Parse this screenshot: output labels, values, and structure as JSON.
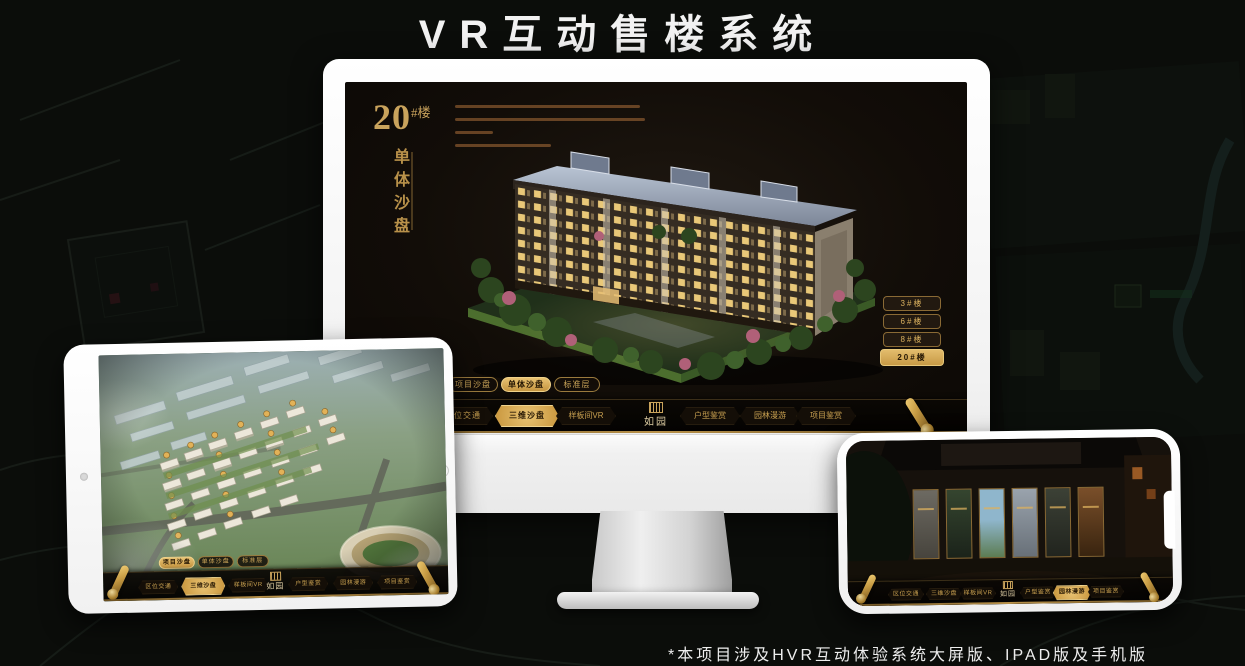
{
  "page": {
    "title": "VR互动售楼系统",
    "footnote": "*本项目涉及HVR互动体验系统大屏版、IPAD版及手机版"
  },
  "colors": {
    "gold": "#c9a35c",
    "gold_active": "#d9ae58",
    "background": "#0b0d0a",
    "screen_dark": "#120d08"
  },
  "monitor_app": {
    "building_no": "20",
    "building_no_suffix": "#楼",
    "subtitle": "单体沙盘",
    "floor_buttons": [
      {
        "label": "3#楼",
        "active": false
      },
      {
        "label": "6#楼",
        "active": false
      },
      {
        "label": "8#楼",
        "active": false
      },
      {
        "label": "20#楼",
        "active": true
      }
    ],
    "view_tabs": [
      {
        "label": "项目沙盘",
        "active": false
      },
      {
        "label": "单体沙盘",
        "active": true
      },
      {
        "label": "标准层",
        "active": false
      }
    ],
    "nav_items": [
      {
        "label": "区位交通",
        "active": false
      },
      {
        "label": "三维沙盘",
        "active": true
      },
      {
        "label": "样板间VR",
        "active": false
      },
      {
        "label": "户型鉴赏",
        "active": false
      },
      {
        "label": "园林漫游",
        "active": false
      },
      {
        "label": "项目鉴赏",
        "active": false
      }
    ],
    "logo_text": "如园",
    "icons": [
      "scroll-icon",
      "seal-icon"
    ]
  },
  "tablet_app": {
    "view_tabs": [
      {
        "label": "项目沙盘",
        "active": true
      },
      {
        "label": "单体沙盘",
        "active": false
      },
      {
        "label": "标准层",
        "active": false
      }
    ],
    "nav_items": [
      {
        "label": "区位交通",
        "active": false
      },
      {
        "label": "三维沙盘",
        "active": true
      },
      {
        "label": "样板间VR",
        "active": false
      },
      {
        "label": "户型鉴赏",
        "active": false
      },
      {
        "label": "园林漫游",
        "active": false
      },
      {
        "label": "项目鉴赏",
        "active": false
      }
    ],
    "logo_text": "如园",
    "icons": [
      "scroll-icon",
      "seal-icon"
    ]
  },
  "phone_app": {
    "nav_items": [
      {
        "label": "区位交通",
        "active": false
      },
      {
        "label": "三维沙盘",
        "active": false
      },
      {
        "label": "样板间VR",
        "active": false
      },
      {
        "label": "户型鉴赏",
        "active": false
      },
      {
        "label": "园林漫游",
        "active": true
      },
      {
        "label": "项目鉴赏",
        "active": false
      }
    ],
    "logo_text": "如园",
    "icons": [
      "scroll-icon",
      "seal-icon"
    ]
  }
}
